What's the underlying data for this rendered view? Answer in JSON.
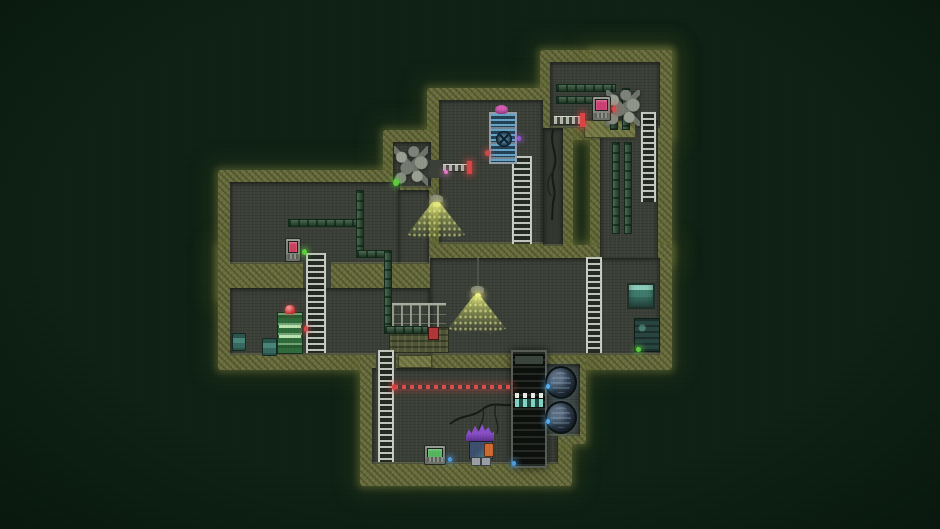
{
  "scene": {
    "width": 940,
    "height": 529,
    "palette": {
      "background": "#0d2013",
      "wall_moss": "#686c3c",
      "wall_moss_light": "#7a7e4a",
      "room_floor": "#3a3f37",
      "ladder_rail": "#c9cec5",
      "pipe_green": "#25482d",
      "laser_red": "#e34a4a",
      "lamp_light": "#e2e878",
      "indicator_green": "#5ccf3a",
      "indicator_red": "#e04848",
      "indicator_blue": "#4aa0e8",
      "hazard_teal": "#82d4c4",
      "shaft_dark": "#0d100d",
      "character_hair": "#8a4fc8"
    },
    "elements": [
      {
        "name": "map-wall-block-topright",
        "type": "moss",
        "x": 540,
        "y": 50,
        "w": 132,
        "h": 90,
        "i": false
      },
      {
        "name": "map-wall-block-rightcolumn",
        "type": "moss",
        "x": 590,
        "y": 50,
        "w": 82,
        "h": 215,
        "i": false
      },
      {
        "name": "map-wall-block-topmiddle",
        "type": "moss",
        "x": 427,
        "y": 88,
        "w": 146,
        "h": 172,
        "i": false
      },
      {
        "name": "map-wall-block-alcove",
        "type": "moss",
        "x": 383,
        "y": 130,
        "w": 60,
        "h": 68,
        "i": false
      },
      {
        "name": "map-wall-block-leftband",
        "type": "moss",
        "x": 218,
        "y": 170,
        "w": 215,
        "h": 130,
        "i": false
      },
      {
        "name": "map-wall-block-midband",
        "type": "moss",
        "x": 218,
        "y": 245,
        "w": 454,
        "h": 125,
        "i": false
      },
      {
        "name": "map-wall-block-bottomroom",
        "type": "moss",
        "x": 360,
        "y": 338,
        "w": 212,
        "h": 148,
        "i": false
      },
      {
        "name": "map-wall-block-turbinenook",
        "type": "moss",
        "x": 536,
        "y": 356,
        "w": 50,
        "h": 88,
        "i": false
      },
      {
        "name": "room-topright-floor",
        "type": "floor",
        "x": 550,
        "y": 62,
        "w": 110,
        "h": 66,
        "i": false
      },
      {
        "name": "room-rightcolumn-floor",
        "type": "floor",
        "x": 600,
        "y": 120,
        "w": 58,
        "h": 140,
        "i": false
      },
      {
        "name": "room-topmiddle-floor",
        "type": "floor",
        "x": 439,
        "y": 100,
        "w": 104,
        "h": 144,
        "i": false
      },
      {
        "name": "room-crackstrip-floor",
        "type": "floor",
        "x": 543,
        "y": 128,
        "w": 20,
        "h": 118,
        "bg": "#31362f",
        "i": false
      },
      {
        "name": "room-alcove-floor",
        "type": "floor",
        "x": 393,
        "y": 142,
        "w": 38,
        "h": 46,
        "i": false
      },
      {
        "name": "passage-alcove-door",
        "type": "floor",
        "open": true,
        "x": 428,
        "y": 160,
        "w": 14,
        "h": 18,
        "i": false
      },
      {
        "name": "room-left-floor",
        "type": "floor",
        "x": 230,
        "y": 182,
        "w": 170,
        "h": 82,
        "i": false
      },
      {
        "name": "room-left-floor-ext",
        "type": "floor",
        "x": 398,
        "y": 190,
        "w": 31,
        "h": 74,
        "i": false
      },
      {
        "name": "passage-ladder-left",
        "type": "floor",
        "open": true,
        "x": 303,
        "y": 260,
        "w": 28,
        "h": 30,
        "i": false
      },
      {
        "name": "room-midright-floor",
        "type": "floor",
        "x": 430,
        "y": 258,
        "w": 230,
        "h": 97,
        "i": false
      },
      {
        "name": "room-midleft-floor",
        "type": "floor",
        "x": 230,
        "y": 288,
        "w": 200,
        "h": 67,
        "i": false
      },
      {
        "name": "room-bottom-floor",
        "type": "floor",
        "x": 372,
        "y": 368,
        "w": 186,
        "h": 96,
        "i": false
      },
      {
        "name": "passage-ladder-bottom",
        "type": "floor",
        "open": true,
        "x": 376,
        "y": 351,
        "w": 20,
        "h": 19,
        "i": false
      },
      {
        "name": "room-turbinenook-floor",
        "type": "floor",
        "x": 545,
        "y": 364,
        "w": 35,
        "h": 72,
        "i": false
      },
      {
        "name": "platform-topright",
        "type": "moss2",
        "x": 584,
        "y": 120,
        "w": 52,
        "h": 18,
        "i": false
      },
      {
        "name": "platform-bottom-ledge",
        "type": "moss2",
        "x": 398,
        "y": 355,
        "w": 34,
        "h": 13,
        "i": false
      },
      {
        "name": "retractable-bridge-topright",
        "type": "bridge",
        "x": 554,
        "y": 116,
        "w": 27,
        "h": 9,
        "i": false
      },
      {
        "name": "bridge-red-tip-topright",
        "type": "tip",
        "x": 580,
        "y": 113,
        "w": 5,
        "h": 14,
        "i": false
      },
      {
        "name": "retractable-bridge-alcove",
        "type": "bridge",
        "x": 443,
        "y": 164,
        "w": 25,
        "h": 8,
        "i": false
      },
      {
        "name": "bridge-red-tip-alcove",
        "type": "tip",
        "x": 467,
        "y": 161,
        "w": 5,
        "h": 13,
        "i": false
      },
      {
        "name": "catwalk-railing",
        "type": "fence",
        "x": 392,
        "y": 303,
        "w": 54,
        "h": 24,
        "i": false
      },
      {
        "name": "catwalk-platform",
        "type": "platform",
        "x": 389,
        "y": 327,
        "w": 60,
        "h": 26,
        "i": false
      },
      {
        "name": "catwalk-hazard-box",
        "type": "rect",
        "x": 428,
        "y": 327,
        "w": 11,
        "h": 13,
        "bg": "#b23636",
        "border": "#4a1414",
        "i": false
      },
      {
        "name": "pipe-topright-upper",
        "type": "pipeh",
        "x": 556,
        "y": 84,
        "w": 60,
        "h": 8,
        "i": false
      },
      {
        "name": "pipe-topright-lower",
        "type": "pipeh",
        "x": 556,
        "y": 96,
        "w": 48,
        "h": 8,
        "i": false
      },
      {
        "name": "pipe-topright-drop-a",
        "type": "pipev",
        "x": 622,
        "y": 88,
        "w": 8,
        "h": 42,
        "i": false
      },
      {
        "name": "pipe-topright-drop-b",
        "type": "pipev",
        "x": 610,
        "y": 100,
        "w": 8,
        "h": 30,
        "i": false
      },
      {
        "name": "pipe-column-left",
        "type": "pipev",
        "x": 612,
        "y": 142,
        "w": 8,
        "h": 92,
        "i": false
      },
      {
        "name": "pipe-column-right",
        "type": "pipev",
        "x": 624,
        "y": 142,
        "w": 8,
        "h": 92,
        "i": false
      },
      {
        "name": "pipe-leftroom-horizontal",
        "type": "pipeh",
        "x": 288,
        "y": 219,
        "w": 74,
        "h": 8,
        "i": false
      },
      {
        "name": "pipe-leftroom-vertical",
        "type": "pipev",
        "x": 356,
        "y": 190,
        "w": 8,
        "h": 68,
        "i": false
      },
      {
        "name": "pipe-scurve-top",
        "type": "pipeh",
        "x": 356,
        "y": 250,
        "w": 36,
        "h": 8,
        "i": false
      },
      {
        "name": "pipe-scurve-drop",
        "type": "pipev",
        "x": 384,
        "y": 250,
        "w": 8,
        "h": 82,
        "i": false
      },
      {
        "name": "pipe-scurve-bottom",
        "type": "pipeh",
        "x": 384,
        "y": 326,
        "w": 44,
        "h": 8,
        "i": false
      },
      {
        "name": "ladder-topmiddle",
        "type": "ladder",
        "x": 512,
        "y": 156,
        "w": 20,
        "h": 88,
        "i": true
      },
      {
        "name": "ladder-left",
        "type": "ladder",
        "x": 306,
        "y": 253,
        "w": 20,
        "h": 100,
        "i": true
      },
      {
        "name": "ladder-bottom",
        "type": "ladder",
        "x": 378,
        "y": 350,
        "w": 16,
        "h": 112,
        "i": true
      },
      {
        "name": "ladder-topright",
        "type": "ladder",
        "x": 641,
        "y": 112,
        "w": 15,
        "h": 90,
        "i": true
      },
      {
        "name": "ladder-midright",
        "type": "ladder",
        "x": 586,
        "y": 257,
        "w": 16,
        "h": 96,
        "i": true
      },
      {
        "name": "wall-crack-right",
        "type": "crack",
        "x": 543,
        "y": 130,
        "w": 26,
        "h": 90,
        "i": false,
        "paths": [
          "M10 0 C6 16 16 24 11 38 C6 52 15 58 10 72 L9 90",
          "M11 40 C4 48 3 58 8 66"
        ]
      },
      {
        "name": "floor-crack-bottom",
        "type": "crack",
        "x": 450,
        "y": 392,
        "w": 70,
        "h": 50,
        "i": false,
        "paths": [
          "M70 12 C54 16 44 8 33 17 C22 26 12 22 0 32",
          "M33 17 C36 29 26 35 30 46",
          "M46 12 C42 24 50 30 47 42"
        ]
      },
      {
        "name": "vent-window",
        "type": "vent",
        "x": 627,
        "y": 283,
        "w": 28,
        "h": 26,
        "i": false
      },
      {
        "name": "dark-machine",
        "type": "dmachine",
        "x": 634,
        "y": 318,
        "w": 26,
        "h": 34,
        "i": false
      },
      {
        "name": "rubble-pile-alcove",
        "type": "rubble",
        "x": 394,
        "y": 146,
        "w": 34,
        "h": 40,
        "i": false
      },
      {
        "name": "rubble-pile-topright",
        "type": "rubble",
        "x": 606,
        "y": 90,
        "w": 34,
        "h": 36,
        "i": false
      },
      {
        "name": "terminal-topright",
        "type": "terminal",
        "x": 592,
        "y": 96,
        "w": 19,
        "h": 25,
        "screen": "#cc3f72",
        "i": true
      },
      {
        "name": "terminal-left",
        "type": "terminal",
        "x": 285,
        "y": 238,
        "w": 16,
        "h": 24,
        "screen": "#cc3f5e",
        "i": true
      },
      {
        "name": "terminal-bottom",
        "type": "terminal",
        "x": 424,
        "y": 445,
        "w": 22,
        "h": 20,
        "screen": "#53b65c",
        "i": true
      },
      {
        "name": "capsule-machine",
        "type": "capsule",
        "x": 277,
        "y": 312,
        "w": 26,
        "h": 42,
        "i": true
      },
      {
        "name": "fan-door-machine",
        "type": "bmachine",
        "x": 489,
        "y": 112,
        "w": 28,
        "h": 52,
        "i": true
      },
      {
        "name": "pink-creature",
        "type": "blob",
        "x": 495,
        "y": 105,
        "w": 13,
        "h": 9,
        "bg": "#d65fb4",
        "i": false
      },
      {
        "name": "barrel-left-wall",
        "type": "barrel",
        "x": 232,
        "y": 333,
        "w": 14,
        "h": 18,
        "i": false
      },
      {
        "name": "barrel-floor",
        "type": "barrel",
        "x": 262,
        "y": 338,
        "w": 15,
        "h": 18,
        "i": false
      },
      {
        "name": "hanging-lamp-top",
        "type": "lamp",
        "x": 430,
        "y": 188,
        "w": 13,
        "h": 19,
        "cord": 7,
        "i": false
      },
      {
        "name": "lamp-light-cone-top",
        "type": "cone",
        "x": 407,
        "y": 202,
        "w": 58,
        "h": 38,
        "i": false
      },
      {
        "name": "hanging-lamp-mid",
        "type": "lamp",
        "x": 471,
        "y": 258,
        "w": 13,
        "h": 40,
        "cord": 28,
        "i": false
      },
      {
        "name": "lamp-light-cone-mid",
        "type": "cone",
        "x": 448,
        "y": 296,
        "w": 58,
        "h": 38,
        "i": false
      },
      {
        "name": "dark-shaft",
        "type": "shaft",
        "x": 511,
        "y": 350,
        "w": 36,
        "h": 118,
        "i": false
      },
      {
        "name": "turbine-upper",
        "type": "turbine",
        "x": 545,
        "y": 366,
        "w": 32,
        "h": 33,
        "i": false
      },
      {
        "name": "turbine-lower",
        "type": "turbine",
        "x": 545,
        "y": 401,
        "w": 32,
        "h": 33,
        "i": false
      },
      {
        "name": "laser-tripwire",
        "type": "laser",
        "x": 394,
        "y": 385,
        "w": 120,
        "h": 4,
        "i": false
      },
      {
        "name": "laser-emitter",
        "type": "dot",
        "x": 392,
        "y": 384,
        "w": 4,
        "h": 6,
        "c": "#d84040",
        "g": "rgba(220,64,64,.6)",
        "i": false
      },
      {
        "name": "light-green-wall-end",
        "type": "dot",
        "x": 393,
        "y": 179,
        "w": 6,
        "h": 7,
        "c": "#5ccf3a",
        "g": "rgba(90,210,60,.6)",
        "i": false
      },
      {
        "name": "light-green-terminal-left",
        "type": "dot",
        "x": 302,
        "y": 249,
        "w": 5,
        "h": 6,
        "c": "#5ccf3a",
        "g": "rgba(90,210,60,.6)",
        "i": false
      },
      {
        "name": "light-green-dark-machine",
        "type": "dot",
        "x": 636,
        "y": 347,
        "w": 5,
        "h": 5,
        "c": "#5ccf3a",
        "g": "rgba(90,210,60,.6)",
        "i": false
      },
      {
        "name": "light-red-terminal-topright",
        "type": "dot",
        "x": 612,
        "y": 106,
        "w": 4,
        "h": 6,
        "c": "#e04848",
        "g": "rgba(225,70,70,.6)",
        "i": false
      },
      {
        "name": "light-red-capsule",
        "type": "dot",
        "x": 304,
        "y": 326,
        "w": 4,
        "h": 6,
        "c": "#e04848",
        "g": "rgba(225,70,70,.6)",
        "i": false
      },
      {
        "name": "light-red-fan-machine",
        "type": "dot",
        "x": 485,
        "y": 150,
        "w": 5,
        "h": 6,
        "c": "#d04848",
        "g": "rgba(208,72,72,.6)",
        "i": false
      },
      {
        "name": "light-purple-fan-machine",
        "type": "dot",
        "x": 517,
        "y": 136,
        "w": 4,
        "h": 5,
        "c": "#9a5ad8",
        "g": "rgba(154,90,216,.6)",
        "i": false
      },
      {
        "name": "sparkle-pink-bridge",
        "type": "dot",
        "x": 444,
        "y": 170,
        "w": 4,
        "h": 4,
        "c": "#e878c8",
        "g": "rgba(232,120,200,.6)",
        "i": false
      },
      {
        "name": "light-blue-terminal-bottom",
        "type": "dot",
        "x": 448,
        "y": 457,
        "w": 4,
        "h": 5,
        "c": "#4aa0e8",
        "g": "rgba(74,160,232,.6)",
        "i": false
      },
      {
        "name": "light-blue-floor-right",
        "type": "dot",
        "x": 512,
        "y": 461,
        "w": 4,
        "h": 5,
        "c": "#4aa0e8",
        "g": "rgba(74,160,232,.6)",
        "i": false
      },
      {
        "name": "light-blue-turbine-upper",
        "type": "dot",
        "x": 546,
        "y": 384,
        "w": 4,
        "h": 5,
        "c": "#58b0f0",
        "g": "rgba(88,176,240,.6)",
        "i": false
      },
      {
        "name": "light-blue-turbine-lower",
        "type": "dot",
        "x": 546,
        "y": 419,
        "w": 4,
        "h": 5,
        "c": "#58b0f0",
        "g": "rgba(88,176,240,.6)",
        "i": false
      },
      {
        "name": "player-character",
        "type": "character",
        "x": 466,
        "y": 424,
        "w": 28,
        "h": 40,
        "i": true,
        "hair": "#8a4fc8",
        "hairDark": "#5c2f8c",
        "body": "#3c4f6e",
        "accent": "#4a8f8f",
        "arm": "#cf6a32",
        "legs": "#9aa0a6"
      }
    ]
  }
}
